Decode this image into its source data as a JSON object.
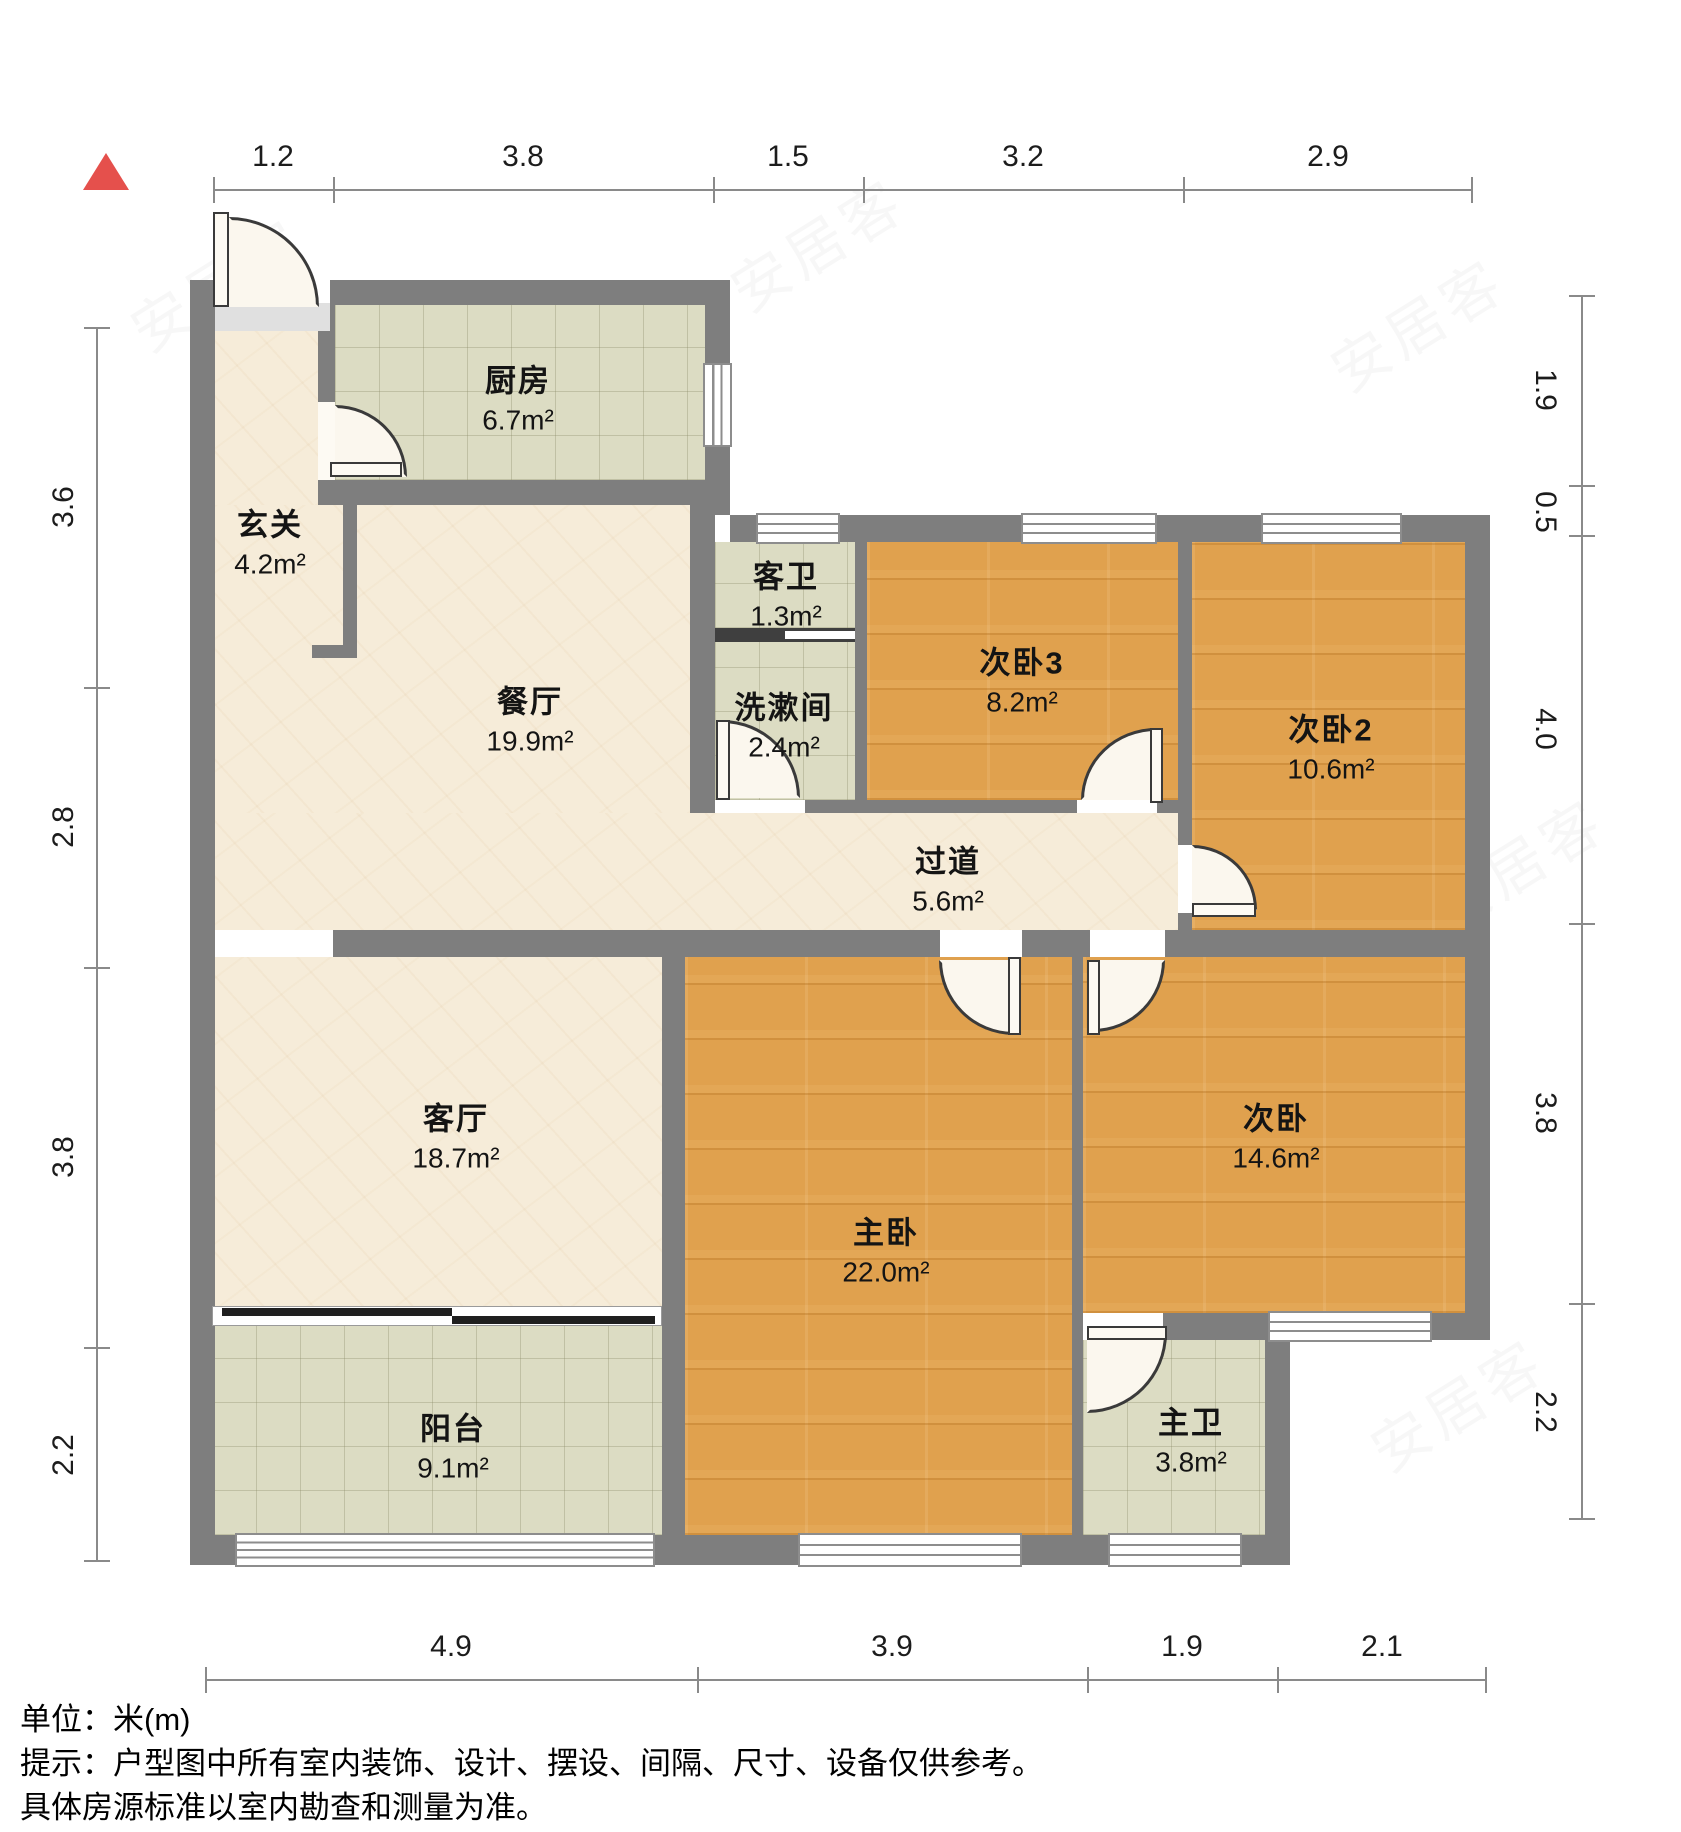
{
  "north_indicator": {
    "icon": "north-triangle",
    "color": "#e5504c"
  },
  "rooms": {
    "xuanguan": {
      "name": "玄关",
      "area": "4.2m²"
    },
    "chufang": {
      "name": "厨房",
      "area": "6.7m²"
    },
    "kewei": {
      "name": "客卫",
      "area": "1.3m²"
    },
    "xishujian": {
      "name": "洗漱间",
      "area": "2.4m²"
    },
    "canting": {
      "name": "餐厅",
      "area": "19.9m²"
    },
    "ciwo3": {
      "name": "次卧3",
      "area": "8.2m²"
    },
    "ciwo2": {
      "name": "次卧2",
      "area": "10.6m²"
    },
    "guodao": {
      "name": "过道",
      "area": "5.6m²"
    },
    "keting": {
      "name": "客厅",
      "area": "18.7m²"
    },
    "zhuwo": {
      "name": "主卧",
      "area": "22.0m²"
    },
    "ciwo": {
      "name": "次卧",
      "area": "14.6m²"
    },
    "zhuwei": {
      "name": "主卫",
      "area": "3.8m²"
    },
    "yangtai": {
      "name": "阳台",
      "area": "9.1m²"
    }
  },
  "dimensions": {
    "top": [
      "1.2",
      "3.8",
      "1.5",
      "3.2",
      "2.9"
    ],
    "left": [
      "3.6",
      "2.8",
      "3.8",
      "2.2"
    ],
    "right": [
      "1.9",
      "0.5",
      "4.0",
      "3.8",
      "2.2"
    ],
    "bottom": [
      "4.9",
      "3.9",
      "1.9",
      "2.1"
    ]
  },
  "footer": {
    "unit_label": "单位：米(m)",
    "tip_line1": "提示：户型图中所有室内装饰、设计、摆设、间隔、尺寸、设备仅供参考。",
    "tip_line2": "具体房源标准以室内勘查和测量为准。"
  },
  "watermark": {
    "text": "安居客"
  },
  "colors": {
    "wall": "#7e7e7e",
    "wood_floor": "#e0a14e",
    "tile_floor": "#dcdcc3",
    "cream_floor": "#f6ecd9",
    "north_marker": "#e5504c"
  }
}
